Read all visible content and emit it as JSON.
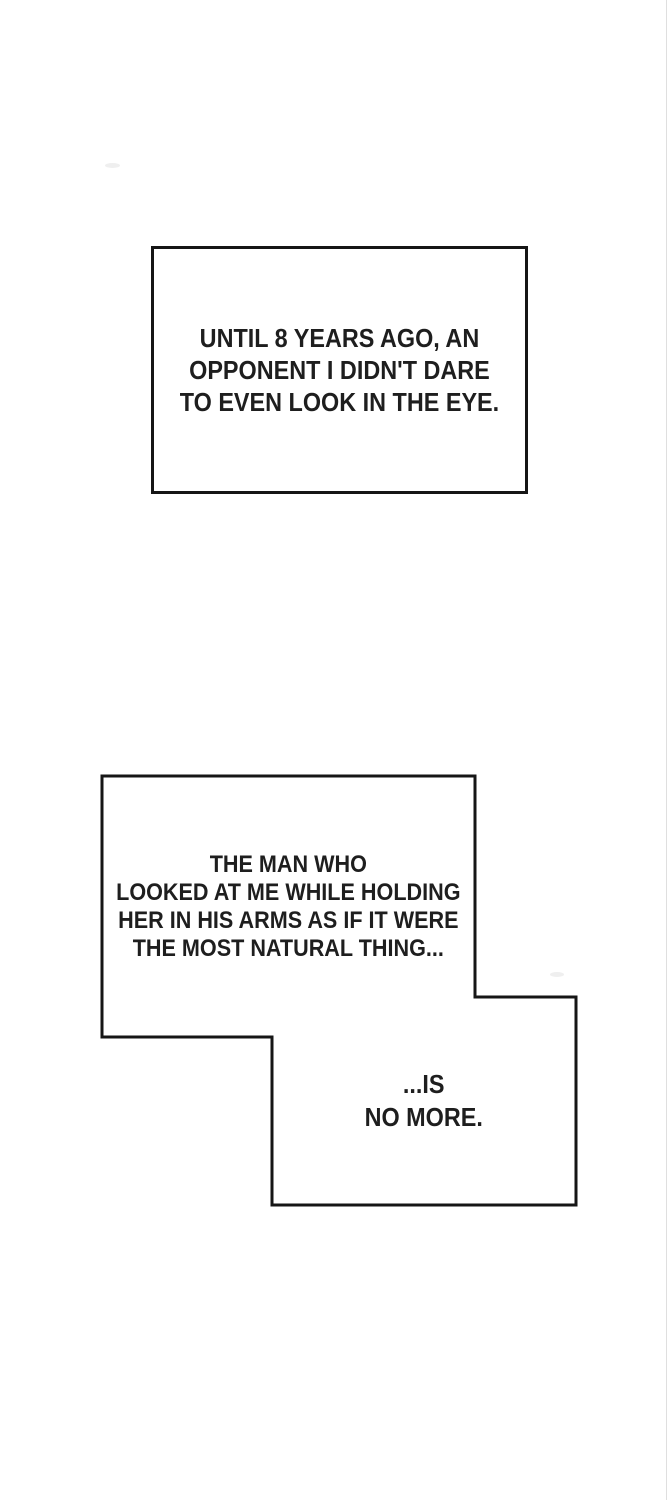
{
  "page": {
    "background_color": "#ffffff",
    "ink_color": "#1e1e1e",
    "panel_border_color": "#161616"
  },
  "narration": {
    "box_top": {
      "lines": [
        "UNTIL 8 YEARS AGO, AN",
        "OPPONENT I DIDN'T DARE",
        "TO EVEN LOOK IN THE EYE."
      ]
    },
    "box_bottom_upper": {
      "lines": [
        "THE MAN WHO",
        "LOOKED AT ME WHILE HOLDING",
        "HER IN HIS ARMS AS IF IT WERE",
        "THE MOST NATURAL THING..."
      ]
    },
    "box_bottom_lower": {
      "lines": [
        "...IS",
        "NO MORE."
      ]
    }
  }
}
